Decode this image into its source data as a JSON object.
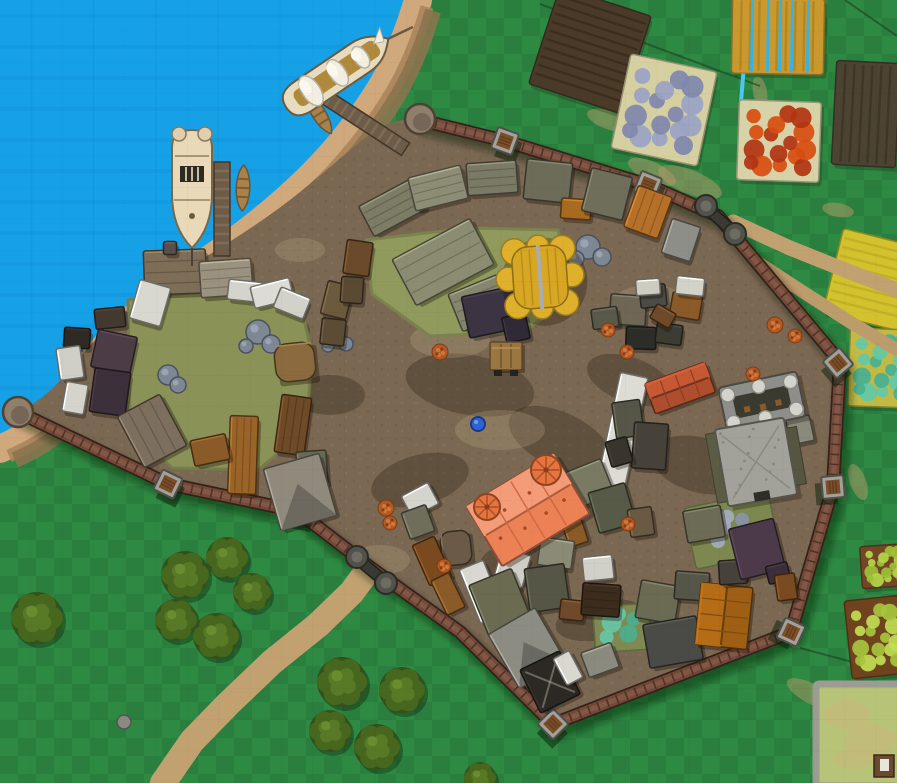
{
  "scene": {
    "kind": "vtt-battle-map",
    "subject": "walled coastal town with harbor, farms and forest"
  },
  "canvas": {
    "width": 897,
    "height": 783
  },
  "palette": {
    "grass": "#2e8a42",
    "grass_alt": "#2a7f3e",
    "water": "#16a1e7",
    "water_streak": "#0f93d8",
    "sand": "#cfa87c",
    "sand_inner": "#a8825a",
    "dirt": "#7a6852",
    "wall_main": "#714b38",
    "wall_dark": "#35211a",
    "wall_light": "#835647",
    "path": "#c2a170",
    "tree_dark": "#33511c",
    "tree_light": "#47671f"
  },
  "terrain": {
    "shoreline": "M418,0 C400,62 378,98 342,142 C306,186 258,226 204,263 C150,300 104,340 70,392 C52,420 34,434 0,449",
    "town_floor": "M420,120 L505,141 L648,185 L718,216 L840,362 L833,487 L791,632 L553,724 L460,632 L371,568 L297,511 L168,484 L18,412 C38,402 52,392 76,362 C100,332 130,305 172,278 C214,251 258,226 300,192 C342,158 362,138 382,127 C396,120 408,118 420,120 Z"
  },
  "wall": {
    "path": "M18,412 L168,484 L297,511 L371,568 L460,632 L553,724 L791,632 L833,487 L840,362 L718,216 L648,185 L505,141 L420,120",
    "towers": [
      [
        505,
        141,
        20
      ],
      [
        648,
        185,
        22
      ],
      [
        838,
        363,
        50
      ],
      [
        833,
        487,
        85
      ],
      [
        791,
        632,
        115
      ],
      [
        553,
        724,
        45
      ],
      [
        297,
        511,
        12
      ],
      [
        168,
        484,
        26
      ]
    ],
    "bastions": [
      [
        18,
        412
      ],
      [
        420,
        119
      ]
    ],
    "gates": [
      {
        "bx": 357,
        "by": 557,
        "cx": 386,
        "cy": 583,
        "mx": 371,
        "my": 570,
        "r": 40
      },
      {
        "bx": 706,
        "by": 206,
        "cx": 735,
        "cy": 234,
        "mx": 720,
        "my": 220,
        "r": 42
      }
    ]
  },
  "fields_format": "center x, center y, w, h, rotation, base color, style",
  "fields": [
    {
      "name": "tilled-field",
      "x": 590,
      "y": 50,
      "w": 96,
      "h": 102,
      "r": 18,
      "c": "#4a3a28",
      "s": "rows-h",
      "sc": "#3a2c1e"
    },
    {
      "name": "blue-flower-plot",
      "x": 664,
      "y": 110,
      "w": 88,
      "h": 96,
      "r": 12,
      "c": "#d6cfa2",
      "s": "plants",
      "p1": "#7f88ac",
      "p2": "#9aa3c4"
    },
    {
      "name": "irrigated-gold-field",
      "x": 778,
      "y": 36,
      "w": 92,
      "h": 76,
      "r": 1,
      "c": "#c9992f",
      "s": "rows-v",
      "sc": "#b2841f",
      "blue_lines": [
        -26,
        -10,
        2,
        14,
        30
      ],
      "stem_x": -34
    },
    {
      "name": "red-flower-plot",
      "x": 779,
      "y": 141,
      "w": 82,
      "h": 80,
      "r": 2,
      "c": "#d8d2a8",
      "s": "plants",
      "p1": "#b23312",
      "p2": "#d84d10"
    },
    {
      "name": "tilled-field",
      "x": 866,
      "y": 114,
      "w": 64,
      "h": 104,
      "r": 3,
      "c": "#4c4332",
      "s": "rows-v",
      "sc": "#3c3426"
    },
    {
      "name": "wheat-field",
      "x": 872,
      "y": 280,
      "w": 80,
      "h": 86,
      "r": 14,
      "c": "#d3c22e",
      "s": "rows-h",
      "sc": "#c0ae24"
    },
    {
      "name": "vegetable-field",
      "x": 882,
      "y": 368,
      "w": 66,
      "h": 78,
      "r": 2,
      "c": "#c2ba44",
      "s": "plants",
      "p1": "#49b091",
      "p2": "#63c8a8"
    },
    {
      "name": "crop-field",
      "x": 886,
      "y": 566,
      "w": 50,
      "h": 42,
      "r": -4,
      "c": "#744626",
      "s": "plants",
      "p1": "#9dc136",
      "p2": "#b5d84a"
    },
    {
      "name": "crop-field",
      "x": 877,
      "y": 637,
      "w": 58,
      "h": 78,
      "r": -6,
      "c": "#70431f",
      "s": "plants",
      "p1": "#a6c63e",
      "p2": "#c0de55"
    },
    {
      "name": "walled-enclosure",
      "x": 861,
      "y": 735,
      "w": 90,
      "h": 102,
      "r": 0,
      "c": "#b7c478",
      "s": "walled",
      "sc": "#9c9c92"
    }
  ],
  "ground_lines": [
    [
      540,
      4,
      760,
      86
    ],
    [
      845,
      0,
      897,
      36
    ],
    [
      762,
      282,
      897,
      330
    ],
    [
      800,
      648,
      897,
      674
    ]
  ],
  "worn_patches": [
    [
      608,
      120,
      22,
      9,
      20
    ],
    [
      652,
      172,
      26,
      10,
      25
    ],
    [
      700,
      242,
      24,
      9,
      35
    ],
    [
      838,
      210,
      16,
      7,
      10
    ],
    [
      858,
      482,
      19,
      8,
      70
    ],
    [
      812,
      694,
      28,
      10,
      28
    ],
    [
      690,
      182,
      34,
      12,
      22
    ],
    [
      760,
      92,
      16,
      7,
      80
    ]
  ],
  "paths": [
    {
      "pts": [
        [
          163,
          783
        ],
        [
          192,
          741
        ],
        [
          228,
          704
        ],
        [
          272,
          662
        ],
        [
          318,
          625
        ],
        [
          352,
          592
        ],
        [
          368,
          570
        ]
      ],
      "w": 26,
      "c": "#c2a170"
    },
    {
      "pts": [
        [
          733,
          222
        ],
        [
          790,
          248
        ],
        [
          850,
          272
        ],
        [
          897,
          290
        ]
      ],
      "w": 15,
      "c": "#c2a170"
    },
    {
      "pts": [
        [
          742,
          252
        ],
        [
          800,
          290
        ],
        [
          850,
          322
        ],
        [
          897,
          350
        ]
      ],
      "w": 13,
      "c": "#bd9c6c"
    }
  ],
  "trees": [
    [
      37,
      618,
      26
    ],
    [
      185,
      575,
      24
    ],
    [
      227,
      558,
      21
    ],
    [
      252,
      592,
      19
    ],
    [
      176,
      620,
      21
    ],
    [
      216,
      636,
      23
    ],
    [
      342,
      682,
      25
    ],
    [
      402,
      690,
      23
    ],
    [
      330,
      731,
      21
    ],
    [
      377,
      747,
      23
    ],
    [
      480,
      778,
      16
    ]
  ],
  "outside_rocks": [
    [
      124,
      722,
      7
    ]
  ],
  "courtyards": [
    {
      "d": "M128,300 L230,288 L298,292 L312,355 L306,430 L258,470 L172,468 L130,425 Z",
      "c": "#8b9257"
    },
    {
      "d": "M366,240 L470,228 L558,230 L572,296 L524,332 L430,336 L372,294 Z",
      "c": "#8f9a5c"
    }
  ],
  "gardens": [
    {
      "x": 622,
      "y": 628,
      "w": 56,
      "h": 46,
      "r": -4,
      "c": "#7e8a52",
      "p1": "#4aae8e",
      "p2": "#66c8a8"
    },
    {
      "x": 732,
      "y": 530,
      "w": 86,
      "h": 62,
      "r": -12,
      "c": "#7c8850",
      "p1": "#8a94a8",
      "p2": "#a4aec0"
    }
  ],
  "dirt_dark": [
    [
      470,
      385,
      130,
      60,
      10
    ],
    [
      560,
      440,
      110,
      55,
      25
    ],
    [
      420,
      480,
      100,
      50,
      -15
    ],
    [
      630,
      380,
      90,
      45,
      20
    ],
    [
      520,
      565,
      80,
      45,
      0
    ],
    [
      700,
      465,
      100,
      55,
      15
    ],
    [
      330,
      395,
      70,
      40,
      0
    ],
    [
      600,
      620,
      90,
      40,
      -10
    ],
    [
      280,
      330,
      60,
      30,
      0
    ]
  ],
  "dirt_light": [
    [
      500,
      430,
      90,
      40
    ],
    [
      450,
      340,
      80,
      36
    ],
    [
      650,
      300,
      70,
      30
    ],
    [
      380,
      560,
      60,
      30
    ],
    [
      210,
      320,
      60,
      30
    ],
    [
      300,
      250,
      50,
      24
    ]
  ],
  "town_rocks": [
    {
      "x": 258,
      "y": 332,
      "b": [
        [
          0,
          0,
          12
        ],
        [
          13,
          12,
          9
        ],
        [
          -12,
          14,
          7
        ]
      ]
    },
    {
      "x": 168,
      "y": 375,
      "b": [
        [
          0,
          0,
          10
        ],
        [
          10,
          10,
          8
        ]
      ]
    },
    {
      "x": 336,
      "y": 336,
      "b": [
        [
          0,
          0,
          9
        ],
        [
          10,
          8,
          7
        ],
        [
          -8,
          10,
          6
        ]
      ]
    },
    {
      "x": 588,
      "y": 247,
      "b": [
        [
          0,
          0,
          12
        ],
        [
          14,
          10,
          9
        ],
        [
          -12,
          12,
          8
        ]
      ]
    }
  ],
  "bushes": [
    [
      440,
      352,
      8
    ],
    [
      608,
      330,
      7
    ],
    [
      627,
      352,
      7
    ],
    [
      775,
      325,
      8
    ],
    [
      795,
      336,
      7
    ],
    [
      753,
      374,
      7
    ],
    [
      628,
      524,
      7
    ],
    [
      444,
      566,
      7
    ],
    [
      386,
      508,
      8
    ],
    [
      390,
      523,
      7
    ]
  ],
  "buildings_format": "[x, y, w, h, rotation_deg, roof_color, style]",
  "buildings": [
    [
      175,
      272,
      62,
      44,
      -2,
      "#7e6e58",
      "planks"
    ],
    [
      226,
      278,
      52,
      36,
      -4,
      "#9a917e",
      "planks"
    ],
    [
      170,
      248,
      13,
      13,
      0,
      "#57504a",
      ""
    ],
    [
      110,
      318,
      30,
      20,
      -6,
      "#433931",
      ""
    ],
    [
      77,
      338,
      26,
      20,
      4,
      "#2f2a24",
      ""
    ],
    [
      114,
      352,
      40,
      38,
      12,
      "#4c3c46",
      ""
    ],
    [
      110,
      392,
      36,
      44,
      8,
      "#3c303a",
      ""
    ],
    [
      70,
      363,
      24,
      32,
      -8,
      "#cfcfc7",
      ""
    ],
    [
      75,
      398,
      22,
      30,
      10,
      "#d4d4cc",
      ""
    ],
    [
      150,
      303,
      32,
      40,
      16,
      "#d8d8d0",
      ""
    ],
    [
      246,
      291,
      36,
      20,
      6,
      "#d4d4cc",
      ""
    ],
    [
      272,
      293,
      40,
      22,
      -14,
      "#dcdcd4",
      ""
    ],
    [
      292,
      303,
      32,
      22,
      22,
      "#d2d2ca",
      ""
    ],
    [
      295,
      362,
      40,
      38,
      -6,
      "#8a6a3e",
      "rounded"
    ],
    [
      293,
      425,
      30,
      58,
      8,
      "#6e4a26",
      "planks"
    ],
    [
      312,
      468,
      30,
      34,
      -4,
      "#6a6a54",
      ""
    ],
    [
      152,
      431,
      48,
      58,
      -28,
      "#7d6f5e",
      "planks"
    ],
    [
      243,
      455,
      28,
      78,
      2,
      "#9a6428",
      "planks"
    ],
    [
      300,
      492,
      58,
      64,
      -16,
      "#8f8a7c",
      "gable"
    ],
    [
      210,
      450,
      36,
      26,
      -12,
      "#8a5a28",
      ""
    ],
    [
      337,
      300,
      26,
      34,
      14,
      "#6b5a3c",
      ""
    ],
    [
      333,
      332,
      24,
      26,
      6,
      "#5c4c36",
      ""
    ],
    [
      358,
      258,
      26,
      34,
      8,
      "#6b4a2c",
      ""
    ],
    [
      352,
      290,
      22,
      26,
      4,
      "#5a4a34",
      ""
    ],
    [
      392,
      208,
      58,
      34,
      -28,
      "#7d7d66",
      "planks"
    ],
    [
      438,
      188,
      54,
      34,
      -14,
      "#8d8d76",
      "planks"
    ],
    [
      492,
      178,
      50,
      32,
      -4,
      "#7a7a66",
      "planks"
    ],
    [
      548,
      181,
      46,
      40,
      6,
      "#6c6c58",
      ""
    ],
    [
      576,
      209,
      30,
      20,
      4,
      "#a86a20",
      ""
    ],
    [
      607,
      194,
      42,
      44,
      14,
      "#6e6e5a",
      ""
    ],
    [
      648,
      212,
      36,
      44,
      20,
      "#b5702a",
      "planks"
    ],
    [
      681,
      240,
      30,
      36,
      18,
      "#8e8e88",
      ""
    ],
    [
      443,
      262,
      88,
      52,
      -28,
      "#8c8c72",
      "planks"
    ],
    [
      485,
      301,
      64,
      40,
      -22,
      "#86866e",
      "planks"
    ],
    [
      492,
      312,
      54,
      42,
      -12,
      "#3c3442",
      ""
    ],
    [
      516,
      328,
      24,
      26,
      -12,
      "#302a36",
      ""
    ],
    [
      628,
      310,
      36,
      30,
      4,
      "#6e6756",
      ""
    ],
    [
      653,
      296,
      26,
      22,
      -6,
      "#4c4c44",
      ""
    ],
    [
      686,
      306,
      30,
      24,
      10,
      "#8a5a28",
      ""
    ],
    [
      641,
      338,
      30,
      22,
      2,
      "#2c2c28",
      ""
    ],
    [
      669,
      334,
      26,
      20,
      8,
      "#3c3c32",
      ""
    ],
    [
      648,
      287,
      24,
      16,
      -4,
      "#ccccc2",
      ""
    ],
    [
      690,
      286,
      28,
      18,
      6,
      "#d2d2c8",
      ""
    ],
    [
      605,
      318,
      26,
      20,
      -8,
      "#59594a",
      ""
    ],
    [
      663,
      316,
      22,
      16,
      30,
      "#6e4a2a",
      ""
    ],
    [
      622,
      433,
      28,
      118,
      12,
      "#dcdcd4",
      ""
    ],
    [
      680,
      388,
      64,
      32,
      -20,
      "#ae4e2e",
      "ridge"
    ],
    [
      628,
      419,
      28,
      36,
      -8,
      "#565648",
      ""
    ],
    [
      650,
      446,
      34,
      46,
      4,
      "#46423a",
      ""
    ],
    [
      619,
      452,
      22,
      26,
      -16,
      "#39352d",
      ""
    ],
    [
      800,
      430,
      24,
      26,
      -12,
      "#8a8a7c",
      ""
    ],
    [
      588,
      484,
      42,
      38,
      -22,
      "#7a7a62",
      ""
    ],
    [
      612,
      508,
      38,
      42,
      -16,
      "#565a46",
      ""
    ],
    [
      641,
      522,
      24,
      28,
      -8,
      "#6a5a44",
      ""
    ],
    [
      575,
      532,
      20,
      26,
      -18,
      "#8a5a28",
      ""
    ],
    [
      556,
      553,
      34,
      28,
      8,
      "#8a8a76",
      ""
    ],
    [
      456,
      548,
      30,
      34,
      -6,
      "#6b5a48",
      "rounded"
    ],
    [
      432,
      561,
      24,
      44,
      -24,
      "#7a4a1e",
      ""
    ],
    [
      448,
      594,
      20,
      38,
      -26,
      "#8a5a28",
      ""
    ],
    [
      482,
      592,
      26,
      58,
      -22,
      "#d8d8d0",
      ""
    ],
    [
      512,
      568,
      30,
      34,
      16,
      "#cfcfc7",
      ""
    ],
    [
      420,
      500,
      30,
      24,
      -28,
      "#d4d4cc",
      ""
    ],
    [
      418,
      522,
      26,
      28,
      -20,
      "#6e6e5a",
      ""
    ],
    [
      500,
      602,
      46,
      54,
      -22,
      "#6b6b52",
      ""
    ],
    [
      547,
      588,
      40,
      44,
      -8,
      "#565646",
      ""
    ],
    [
      527,
      648,
      54,
      62,
      -30,
      "#8c8c82",
      "gable"
    ],
    [
      550,
      682,
      44,
      48,
      -26,
      "#2c2824",
      "cross"
    ],
    [
      572,
      610,
      24,
      20,
      6,
      "#6e4a2a",
      ""
    ],
    [
      601,
      600,
      38,
      32,
      4,
      "#3c2c1e",
      "planks"
    ],
    [
      598,
      568,
      30,
      24,
      -6,
      "#d0d0c8",
      ""
    ],
    [
      658,
      602,
      40,
      38,
      10,
      "#6b6b54",
      ""
    ],
    [
      692,
      586,
      34,
      28,
      4,
      "#565648",
      ""
    ],
    [
      673,
      642,
      54,
      44,
      -10,
      "#4a4a46",
      ""
    ],
    [
      724,
      616,
      52,
      62,
      6,
      "#9e5f14",
      "ridge"
    ],
    [
      733,
      572,
      28,
      24,
      -4,
      "#46423a",
      ""
    ],
    [
      757,
      549,
      46,
      52,
      -14,
      "#4c3a4a",
      ""
    ],
    [
      778,
      573,
      22,
      18,
      -14,
      "#3c2e3a",
      ""
    ],
    [
      704,
      524,
      38,
      32,
      -10,
      "#6c6c56",
      ""
    ],
    [
      786,
      587,
      20,
      26,
      -8,
      "#7a4a20",
      ""
    ],
    [
      600,
      660,
      32,
      26,
      -20,
      "#8a8a7e",
      ""
    ],
    [
      568,
      668,
      18,
      30,
      -28,
      "#d8d8d0",
      ""
    ]
  ],
  "landmarks": {
    "yellow_thatch_hall": {
      "x": 540,
      "y": 277,
      "w": 62,
      "h": 68,
      "r": -4,
      "roof": "#d7a622",
      "lobe": "#dfb02c",
      "ridge": "#a8adb4"
    },
    "orange_manor": {
      "x": 528,
      "y": 510,
      "w": 102,
      "h": 70,
      "r": -31,
      "roof": "#ed8156",
      "roof_light": "#f49b78",
      "seam": "#cf6a42",
      "turrets": [
        [
          546,
          470,
          15
        ],
        [
          487,
          507,
          13
        ]
      ],
      "turret_fill": "#e8733c"
    },
    "keep": {
      "gx": 762,
      "gy": 402,
      "gr": -12,
      "bx": 756,
      "by": 462,
      "br": -10,
      "ring": "#8e8e8a",
      "court": "#3a3a30",
      "turret": "#d4d4cc",
      "body": "#a2a29a",
      "moss": "#5c5c44",
      "door": "#2e2e28"
    }
  },
  "harbor": {
    "piers": [
      {
        "x": 222,
        "y": 209,
        "w": 16,
        "h": 94,
        "r": 0
      },
      {
        "x": 356,
        "y": 117,
        "w": 118,
        "h": 15,
        "r": 33
      }
    ],
    "ships": [
      {
        "kind": "galleon-moored",
        "x": 192,
        "y": 186,
        "r": 0
      },
      {
        "kind": "galleon-sails",
        "x": 336,
        "y": 74,
        "r": -34
      }
    ],
    "rowboats": [
      [
        243,
        188,
        2
      ],
      [
        319,
        114,
        -32
      ]
    ]
  },
  "props": {
    "cart": {
      "x": 506,
      "y": 356
    },
    "pond": {
      "x": 478,
      "y": 424
    }
  }
}
